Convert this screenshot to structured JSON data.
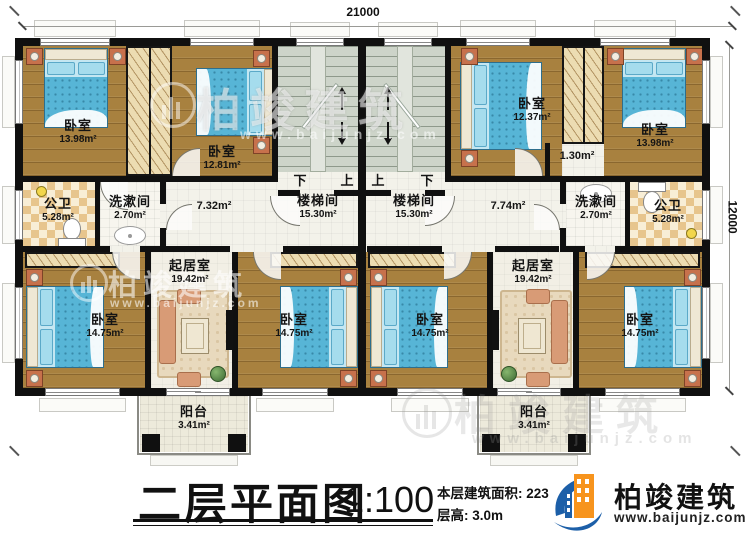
{
  "dimensions": {
    "top": "21000",
    "right": "12000"
  },
  "stairs": {
    "label": "楼梯间",
    "area": "15.30m²",
    "down": "下",
    "up": "上"
  },
  "rooms": {
    "bedroom_tl": {
      "label": "卧室",
      "area": "13.98m²"
    },
    "bedroom_tl2": {
      "label": "卧室",
      "area": "12.81m²"
    },
    "bath_left": {
      "label": "公卫",
      "area": "5.28m²"
    },
    "wash_left": {
      "label": "洗漱间",
      "area": "2.70m²"
    },
    "hall_left": {
      "area": "7.32m²"
    },
    "hall_right": {
      "area": "7.74m²"
    },
    "nook_right": {
      "area": "1.30m²"
    },
    "bedroom_tr1": {
      "label": "卧室",
      "area": "12.37m²"
    },
    "bedroom_tr": {
      "label": "卧室",
      "area": "13.98m²"
    },
    "wash_right": {
      "label": "洗漱间",
      "area": "2.70m²"
    },
    "bath_right": {
      "label": "公卫",
      "area": "5.28m²"
    },
    "living_left": {
      "label": "起居室",
      "area": "19.42m²"
    },
    "living_right": {
      "label": "起居室",
      "area": "19.42m²"
    },
    "bedroom_bl": {
      "label": "卧室",
      "area": "14.75m²"
    },
    "bedroom_bml": {
      "label": "卧室",
      "area": "14.75m²"
    },
    "bedroom_bmr": {
      "label": "卧室",
      "area": "14.75m²"
    },
    "bedroom_br": {
      "label": "卧室",
      "area": "14.75m²"
    },
    "balcony_left": {
      "label": "阳台",
      "area": "3.41m²"
    },
    "balcony_right": {
      "label": "阳台",
      "area": "3.41m²"
    }
  },
  "title_block": {
    "title": "二层平面图",
    "scale": "1:100",
    "area_text": "本层建筑面积: 223",
    "height_text": "层高: 3.0m"
  },
  "brand": {
    "name": "柏竣建筑",
    "website": "www.baijunjz.com"
  },
  "colors": {
    "wall": "#101010",
    "bed_blue": "#57b5d6",
    "brand_blue": "#1c5fa8",
    "brand_orange": "#f7941d"
  }
}
